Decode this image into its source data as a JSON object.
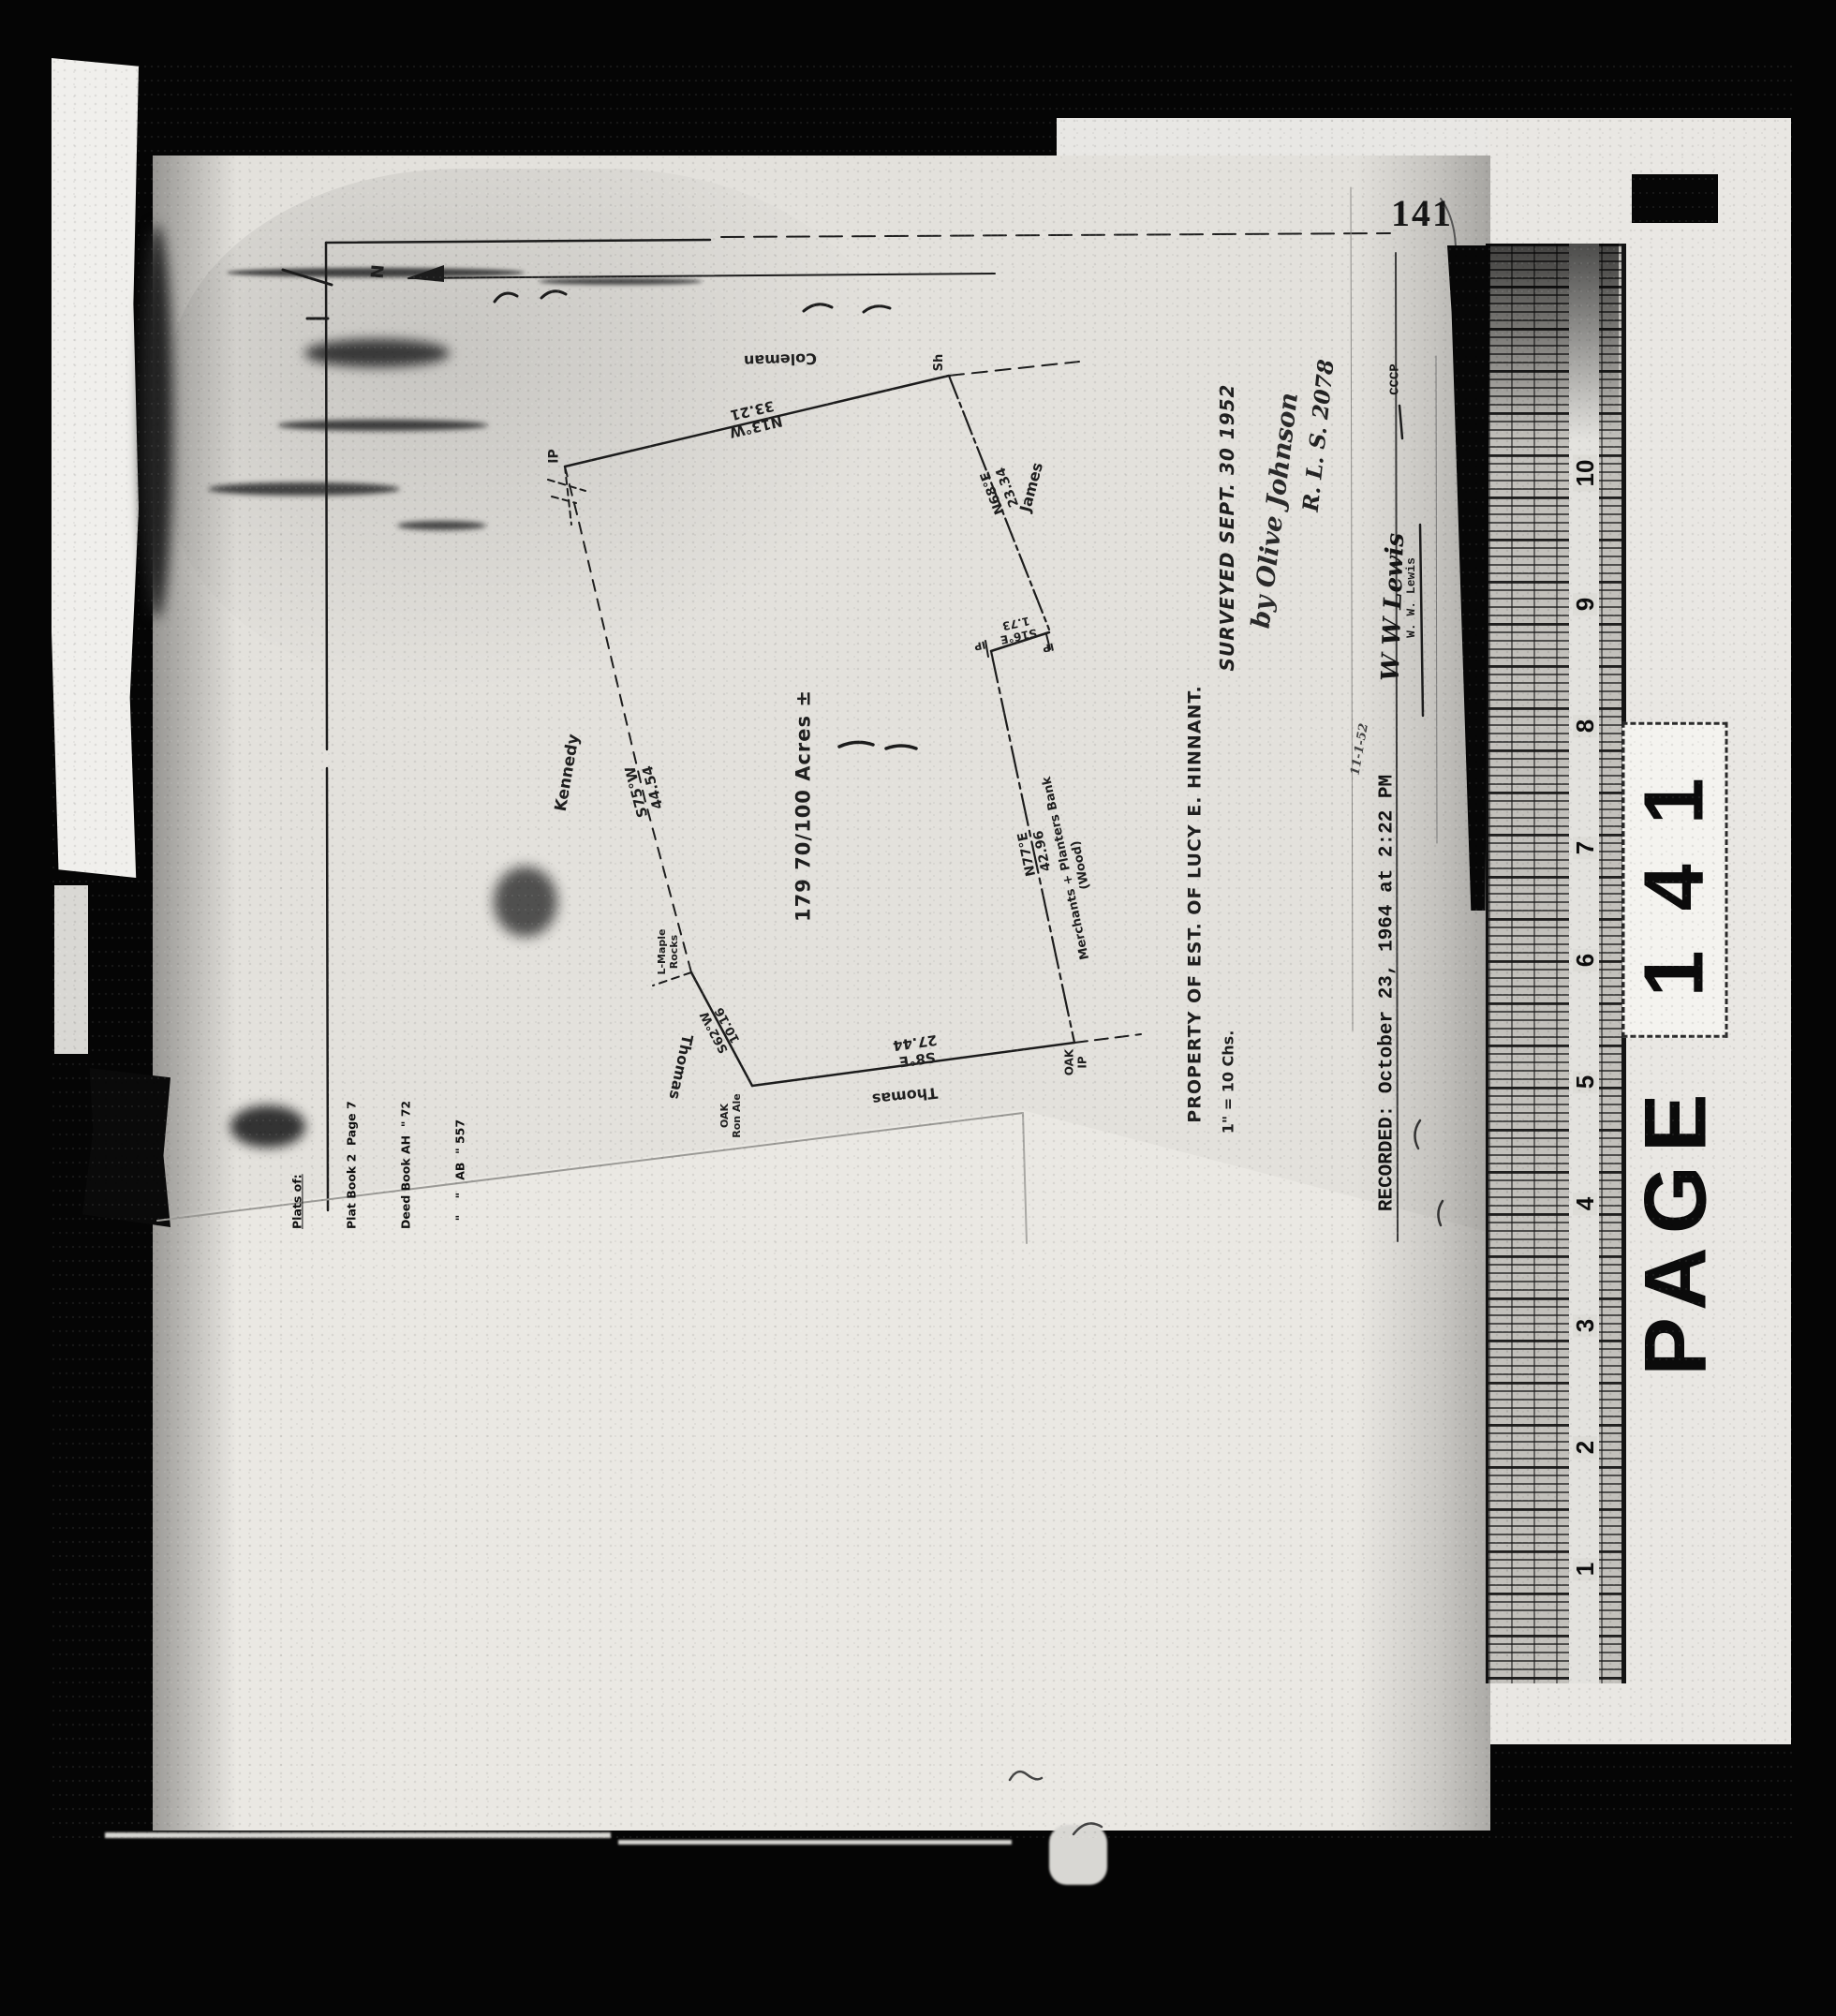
{
  "scan": {
    "printed_page_number": "141",
    "stamp": {
      "word": "PAGE",
      "number": "141"
    },
    "ruler_numbers": [
      "10",
      "9",
      "8",
      "7",
      "6",
      "5",
      "4",
      "3",
      "2",
      "1"
    ]
  },
  "plat": {
    "north_label": "N",
    "area_label": "179 70/100 Acres ±",
    "neighbors": {
      "north": "Coleman",
      "east": "James",
      "west": "Kennedy",
      "southwest": "Thomas",
      "south": "Thomas",
      "southeast_bank": "Merchants + Planters Bank\n(Wood)"
    },
    "corners": {
      "nw": "IP",
      "ne": "Sh",
      "jog_left": "IP",
      "jog_right": "IP",
      "se": "OAK\nIP",
      "sw": "OAK\nRon Ale",
      "west_point": "L-Maple\nRocks"
    },
    "bearings": {
      "north_edge": "N13°W\n33.21",
      "northeast_edge": "N68°E\n23.34",
      "jog_edge": "S16°E\n1.73",
      "east_edge": "N77°E\n42.96",
      "south_edge": "S8°E\n27.44",
      "southwest_edge": "S62°W\n10.16",
      "west_edge": "S75°W\n44.54"
    },
    "title": {
      "property": "PROPERTY OF EST. OF LUCY E. HINNANT.",
      "scale": "1\" = 10 Chs.",
      "surveyed": "SURVEYED   SEPT. 30 1952",
      "surveyor_signature": "by Olive Johnson",
      "license": "R. L. S. 2078",
      "note_date": "11-1-52",
      "recorded": "RECORDED:  October 23, 1964 at 2:22 PM",
      "clerk_signature": "W W Lewis",
      "clerk_name": "W. W. Lewis",
      "clerk_mark": "CCCP"
    },
    "references": {
      "heading": "Plats of:",
      "line1": "Plat Book 2  Page 7",
      "line2": "Deed Book AH  \" 72",
      "line3": "  \"    \"   AB  \" 557"
    }
  }
}
